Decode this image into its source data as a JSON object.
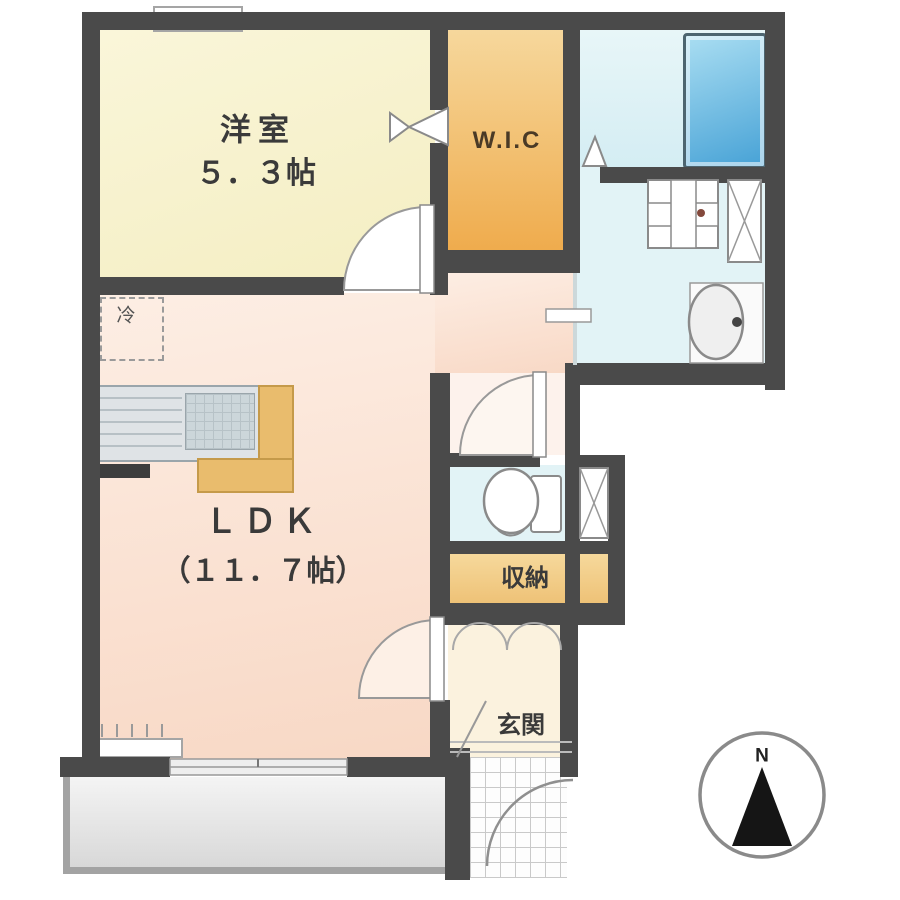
{
  "plan_title": "1LDK apartment floor plan",
  "rooms": {
    "western_room": {
      "name": "洋室",
      "size": "５．３帖"
    },
    "walk_in_closet": {
      "name": "W.I.C"
    },
    "ldk": {
      "name": "ＬＤＫ",
      "size": "（１１．７帖）"
    },
    "storage": {
      "name": "収納"
    },
    "entrance": {
      "name": "玄関"
    }
  },
  "labels": {
    "refrigerator": "冷",
    "compass_north": "N"
  },
  "fixtures": [
    "bathtub",
    "washbasin-vanity",
    "washing-machine-pan",
    "shelf-unit",
    "toilet",
    "kitchen-counter",
    "kitchen-sink",
    "refrigerator-space",
    "entrance-porch",
    "balcony"
  ],
  "colors": {
    "wall": "#4a4a4a",
    "western_room_fill": "#f6f0cc",
    "wic_fill": "#f2bd66",
    "ldk_fill": "#fae3d4",
    "wet_area_fill": "#e2f3f6",
    "bathtub_fill": "#5fb3dd",
    "storage_fill": "#f2cf8c",
    "entrance_fill": "#fbf2de",
    "balcony_fill": "#e3e3e3"
  }
}
